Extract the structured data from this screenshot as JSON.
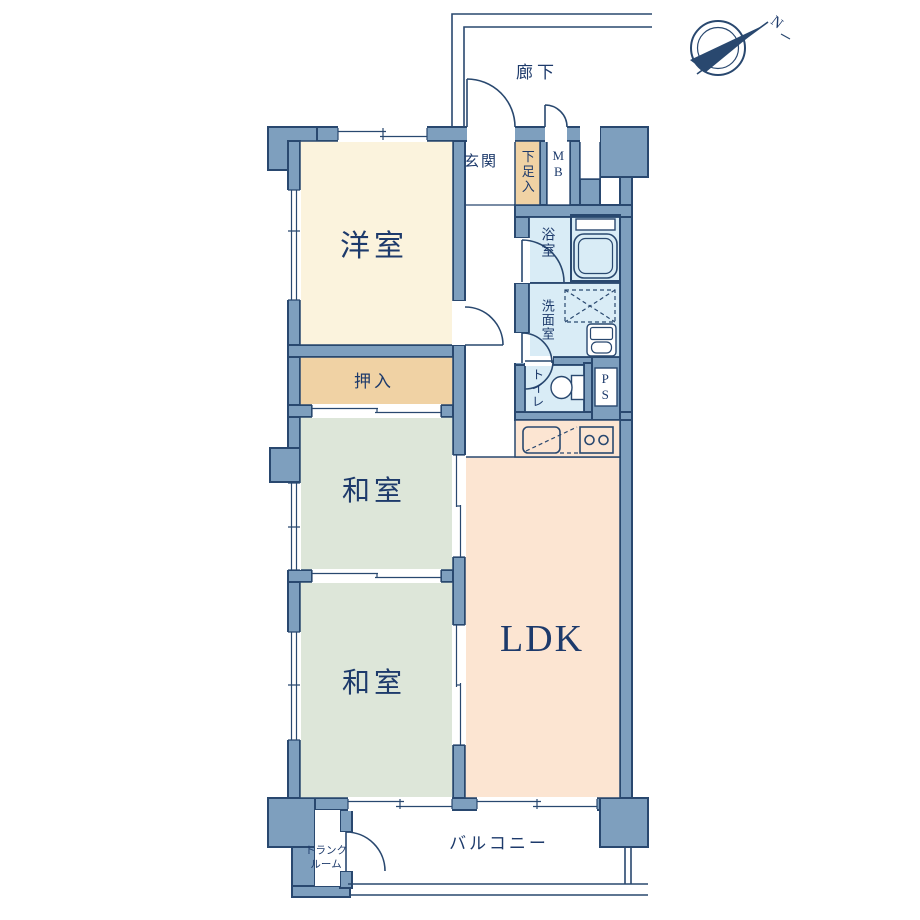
{
  "palette": {
    "wall_fill": "#7e9fbe",
    "wall_line": "#29486f",
    "text": "#1d3a6b",
    "room_western": "#fbf3dd",
    "room_closet": "#f0d2a4",
    "room_tatami": "#dde6d9",
    "room_ldk": "#fce5d2",
    "room_wet": "#d9ecf6"
  },
  "rooms": {
    "western_room": {
      "label": "洋室"
    },
    "closet": {
      "label": "押入"
    },
    "tatami_room_1": {
      "label": "和室"
    },
    "tatami_room_2": {
      "label": "和室"
    },
    "ldk": {
      "label": "LDK"
    },
    "entrance": {
      "label": "玄関"
    },
    "shoe_box": {
      "label": "下足入"
    },
    "meter_box": {
      "label": "MB"
    },
    "bathroom": {
      "label": "浴室"
    },
    "washroom": {
      "label": "洗面室"
    },
    "toilet": {
      "label": "トイレ"
    },
    "pipe_space": {
      "label": "PS"
    },
    "corridor": {
      "label": "廊下"
    },
    "balcony": {
      "label": "バルコニー"
    },
    "trunk_room": {
      "line1": "トランク",
      "line2": "ルーム"
    }
  },
  "compass": {
    "north_label": "N"
  }
}
